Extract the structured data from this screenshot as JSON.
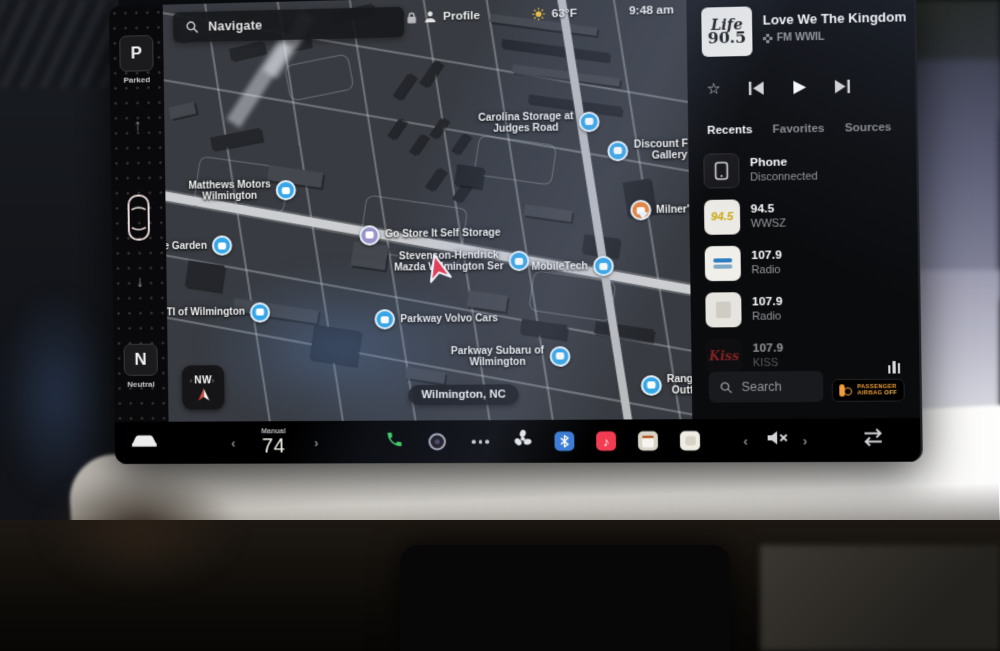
{
  "status": {
    "time": "9:48 am",
    "temperature": "63°F",
    "profile": "Profile",
    "navigate_placeholder": "Navigate"
  },
  "gear": {
    "current": "P",
    "current_label": "Parked",
    "alt": "N",
    "alt_label": "Neutral"
  },
  "map": {
    "locality": "Wilmington, NC",
    "compass": "NW",
    "pois": [
      {
        "line1": "Carolina Storage at",
        "line2": "Judges Road"
      },
      {
        "line1": "Discount Furn",
        "line2": "Gallery"
      },
      {
        "line1": "Matthews Motors",
        "line2": "Wilmington"
      },
      {
        "line1": "Milner's",
        "line2": ""
      },
      {
        "line1": "one Garden",
        "line2": ""
      },
      {
        "line1": "Go Store It Self Storage",
        "line2": ""
      },
      {
        "line1": "Stevenson-Hendrick",
        "line2": "Mazda Wilmington Ser"
      },
      {
        "line1": "MobileTech",
        "line2": ""
      },
      {
        "line1": "TI of Wilmington",
        "line2": ""
      },
      {
        "line1": "Parkway Volvo Cars",
        "line2": ""
      },
      {
        "line1": "Parkway Subaru of",
        "line2": "Wilmington"
      },
      {
        "line1": "Range Ti",
        "line2": "Outfitti"
      }
    ]
  },
  "media": {
    "album_art": {
      "line1": "Life",
      "line2": "90.5"
    },
    "title": "Love We The Kingdom",
    "source": "FM WWIL",
    "tabs": {
      "recents": "Recents",
      "favorites": "Favorites",
      "sources": "Sources"
    },
    "list": [
      {
        "title": "Phone",
        "subtitle": "Disconnected"
      },
      {
        "title": "94.5",
        "subtitle": "WWSZ",
        "logo": "94.5"
      },
      {
        "title": "107.9",
        "subtitle": "Radio"
      },
      {
        "title": "107.9",
        "subtitle": "Radio"
      },
      {
        "title": "107.9",
        "subtitle": "KISS",
        "logo": "Kiss"
      }
    ],
    "search_placeholder": "Search"
  },
  "airbag": {
    "line1": "PASSENGER",
    "line2": "AIRBAG",
    "state": "OFF"
  },
  "climate": {
    "mode": "Manual",
    "temperature": "74"
  },
  "colors": {
    "pin_blue": "#35a6e8",
    "pin_orange": "#e8833a",
    "airbag_amber": "#f09f3c",
    "phone_green": "#3ecf5e",
    "music_red": "#f23c52",
    "nav_arrow_red": "#e8384f"
  }
}
